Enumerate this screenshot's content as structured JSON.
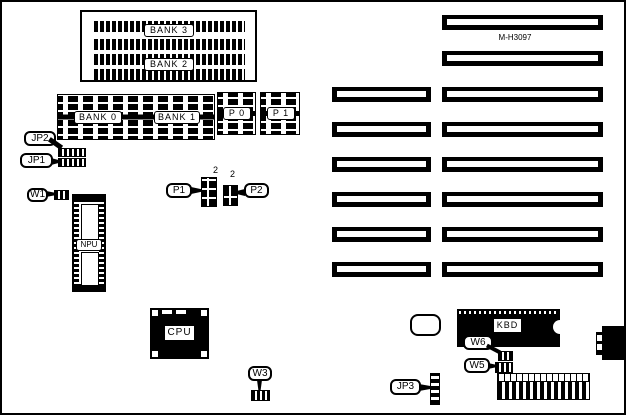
{
  "diagram": {
    "model_label": "M-H3097",
    "memory": {
      "bank3": "BANK 3",
      "bank2": "BANK 2",
      "bank0": "BANK 0",
      "bank1": "BANK 1",
      "p0": "P 0",
      "p1": "P 1"
    },
    "jumpers": {
      "jp1": "JP1",
      "jp2": "JP2",
      "jp3": "JP3",
      "w1": "W1",
      "w3": "W3",
      "w5": "W5",
      "w6": "W6",
      "p1": "P1",
      "p2": "P2",
      "p1_pin": "2",
      "p2_pin": "2"
    },
    "chips": {
      "npu": "NPU",
      "cpu": "CPU",
      "kbd": "KBD"
    },
    "slots": {
      "rows": [
        {
          "has_left": false
        },
        {
          "has_left": false
        },
        {
          "has_left": true
        },
        {
          "has_left": true
        },
        {
          "has_left": true
        },
        {
          "has_left": true
        },
        {
          "has_left": true
        },
        {
          "has_left": true
        }
      ]
    },
    "colors": {
      "line": "#000000",
      "bg": "#ffffff"
    }
  }
}
